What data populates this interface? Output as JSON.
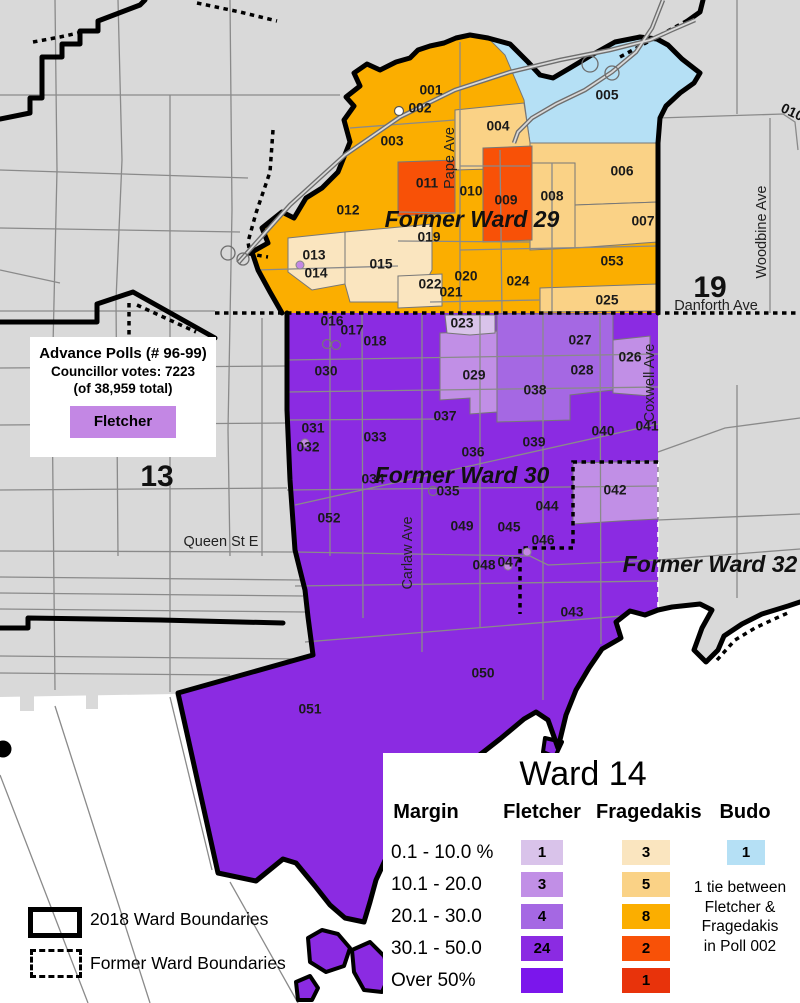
{
  "palette": {
    "background": "#d9d9d9",
    "water": "#ffffff",
    "street": "#8a8a8a",
    "boundary": "#000000",
    "fletcher": [
      "#d9c3ea",
      "#c18fe6",
      "#a568e3",
      "#8b2be2",
      "#7b16ec"
    ],
    "fragedakis": [
      "#fae5bf",
      "#fad286",
      "#fbae00",
      "#f85107",
      "#e8330b"
    ],
    "budo": [
      "#b5e0f5"
    ],
    "fletcher_box": "#c387e4"
  },
  "map": {
    "ward_names": [
      {
        "label": "Former Ward 29",
        "x": 472,
        "y": 221
      },
      {
        "label": "Former Ward 30",
        "x": 462,
        "y": 477
      },
      {
        "label": "Former Ward 32",
        "x": 710,
        "y": 566
      }
    ],
    "ward_numbers": [
      {
        "label": "19",
        "x": 710,
        "y": 289,
        "size": 30,
        "rotate": 0
      },
      {
        "label": "13",
        "x": 157,
        "y": 478,
        "size": 30,
        "rotate": 0
      },
      {
        "label": "010",
        "x": 792,
        "y": 113,
        "size": 14,
        "rotate": 25
      }
    ],
    "streets": [
      {
        "label": "Pape Ave",
        "x": 450,
        "y": 158,
        "vertical": true
      },
      {
        "label": "Carlaw Ave",
        "x": 408,
        "y": 553,
        "vertical": true
      },
      {
        "label": "Coxwell Ave",
        "x": 650,
        "y": 383,
        "vertical": true
      },
      {
        "label": "Woodbine Ave",
        "x": 762,
        "y": 232,
        "vertical": true
      },
      {
        "label": "Danforth Ave",
        "x": 716,
        "y": 306,
        "vertical": false
      },
      {
        "label": "Queen St E",
        "x": 221,
        "y": 542,
        "vertical": false
      }
    ],
    "polls": [
      {
        "id": "001",
        "x": 431,
        "y": 91,
        "cat": "g3"
      },
      {
        "id": "002",
        "x": 420,
        "y": 109,
        "cat": "g3"
      },
      {
        "id": "003",
        "x": 392,
        "y": 142,
        "cat": "g3"
      },
      {
        "id": "004",
        "x": 498,
        "y": 127,
        "cat": "g2"
      },
      {
        "id": "005",
        "x": 607,
        "y": 96,
        "cat": "b1"
      },
      {
        "id": "006",
        "x": 622,
        "y": 172,
        "cat": "g2"
      },
      {
        "id": "007",
        "x": 643,
        "y": 222,
        "cat": "g2"
      },
      {
        "id": "008",
        "x": 552,
        "y": 197,
        "cat": "g2"
      },
      {
        "id": "009",
        "x": 506,
        "y": 201,
        "cat": "g4"
      },
      {
        "id": "010",
        "x": 471,
        "y": 192,
        "cat": "g3"
      },
      {
        "id": "011",
        "x": 427,
        "y": 184,
        "cat": "g4"
      },
      {
        "id": "012",
        "x": 348,
        "y": 211,
        "cat": "g3"
      },
      {
        "id": "013",
        "x": 314,
        "y": 256,
        "cat": "g1"
      },
      {
        "id": "014",
        "x": 316,
        "y": 274,
        "cat": "g1"
      },
      {
        "id": "015",
        "x": 381,
        "y": 265,
        "cat": "g1"
      },
      {
        "id": "016",
        "x": 332,
        "y": 322,
        "cat": "f4"
      },
      {
        "id": "017",
        "x": 352,
        "y": 331,
        "cat": "f4"
      },
      {
        "id": "018",
        "x": 375,
        "y": 342,
        "cat": "f4"
      },
      {
        "id": "019",
        "x": 429,
        "y": 238,
        "cat": "g3"
      },
      {
        "id": "020",
        "x": 466,
        "y": 277,
        "cat": "g3"
      },
      {
        "id": "021",
        "x": 451,
        "y": 293,
        "cat": "g3"
      },
      {
        "id": "022",
        "x": 430,
        "y": 285,
        "cat": "g1"
      },
      {
        "id": "023",
        "x": 462,
        "y": 324,
        "cat": "f1"
      },
      {
        "id": "024",
        "x": 518,
        "y": 282,
        "cat": "g3"
      },
      {
        "id": "025",
        "x": 607,
        "y": 301,
        "cat": "g2"
      },
      {
        "id": "026",
        "x": 630,
        "y": 358,
        "cat": "f2"
      },
      {
        "id": "027",
        "x": 580,
        "y": 341,
        "cat": "f3"
      },
      {
        "id": "028",
        "x": 582,
        "y": 371,
        "cat": "f3"
      },
      {
        "id": "029",
        "x": 474,
        "y": 376,
        "cat": "f2"
      },
      {
        "id": "030",
        "x": 326,
        "y": 372,
        "cat": "f4"
      },
      {
        "id": "031",
        "x": 313,
        "y": 429,
        "cat": "f4"
      },
      {
        "id": "032",
        "x": 308,
        "y": 448,
        "cat": "f4"
      },
      {
        "id": "033",
        "x": 375,
        "y": 438,
        "cat": "f4"
      },
      {
        "id": "034",
        "x": 373,
        "y": 480,
        "cat": "f4"
      },
      {
        "id": "035",
        "x": 448,
        "y": 492,
        "cat": "f4"
      },
      {
        "id": "036",
        "x": 473,
        "y": 453,
        "cat": "f4"
      },
      {
        "id": "037",
        "x": 445,
        "y": 417,
        "cat": "f4"
      },
      {
        "id": "038",
        "x": 535,
        "y": 391,
        "cat": "f3"
      },
      {
        "id": "039",
        "x": 534,
        "y": 443,
        "cat": "f4"
      },
      {
        "id": "040",
        "x": 603,
        "y": 432,
        "cat": "f4"
      },
      {
        "id": "041",
        "x": 647,
        "y": 427,
        "cat": "f4"
      },
      {
        "id": "042",
        "x": 615,
        "y": 491,
        "cat": "f2"
      },
      {
        "id": "043",
        "x": 572,
        "y": 613,
        "cat": "f4"
      },
      {
        "id": "044",
        "x": 547,
        "y": 507,
        "cat": "f4"
      },
      {
        "id": "045",
        "x": 509,
        "y": 528,
        "cat": "f4"
      },
      {
        "id": "046",
        "x": 543,
        "y": 541,
        "cat": "f4"
      },
      {
        "id": "047",
        "x": 509,
        "y": 563,
        "cat": "f4"
      },
      {
        "id": "048",
        "x": 484,
        "y": 566,
        "cat": "f4"
      },
      {
        "id": "049",
        "x": 462,
        "y": 527,
        "cat": "f4"
      },
      {
        "id": "050",
        "x": 483,
        "y": 674,
        "cat": "f4"
      },
      {
        "id": "051",
        "x": 310,
        "y": 710,
        "cat": "f4"
      },
      {
        "id": "052",
        "x": 329,
        "y": 519,
        "cat": "f4"
      },
      {
        "id": "053",
        "x": 612,
        "y": 262,
        "cat": "g3"
      }
    ],
    "markers": {
      "tie": [
        [
          399,
          111
        ]
      ],
      "advance": [
        [
          300,
          265
        ],
        [
          305,
          443
        ],
        [
          527,
          552
        ],
        [
          508,
          566
        ]
      ],
      "plain": [
        [
          327,
          344
        ],
        [
          336,
          345
        ],
        [
          433,
          491
        ]
      ]
    }
  },
  "info_box": {
    "title": "Advance Polls (# 96-99)",
    "line1": "Councillor votes: 7223",
    "line2": "(of 38,959 total)",
    "swatch_label": "Fletcher"
  },
  "legend": {
    "title": "Ward 14",
    "margin_header": "Margin",
    "columns": [
      {
        "key": "fletcher",
        "label": "Fletcher"
      },
      {
        "key": "fragedakis",
        "label": "Fragedakis"
      },
      {
        "key": "budo",
        "label": "Budo"
      }
    ],
    "margin_rows": [
      {
        "label": "0.1 - 10.0 %",
        "fletcher": "1",
        "fragedakis": "3",
        "budo": "1"
      },
      {
        "label": "10.1 - 20.0",
        "fletcher": "3",
        "fragedakis": "5",
        "budo": null
      },
      {
        "label": "20.1 - 30.0",
        "fletcher": "4",
        "fragedakis": "8",
        "budo": null
      },
      {
        "label": "30.1 - 50.0",
        "fletcher": "24",
        "fragedakis": "2",
        "budo": null
      },
      {
        "label": "Over 50%",
        "fletcher": "",
        "fragedakis": "1",
        "budo": null
      }
    ],
    "tie_note": [
      "1 tie between",
      "Fletcher &",
      "Fragedakis",
      "in Poll 002"
    ]
  },
  "boundaries_legend": {
    "solid_label": "2018 Ward Boundaries",
    "dashed_label": "Former Ward Boundaries"
  }
}
